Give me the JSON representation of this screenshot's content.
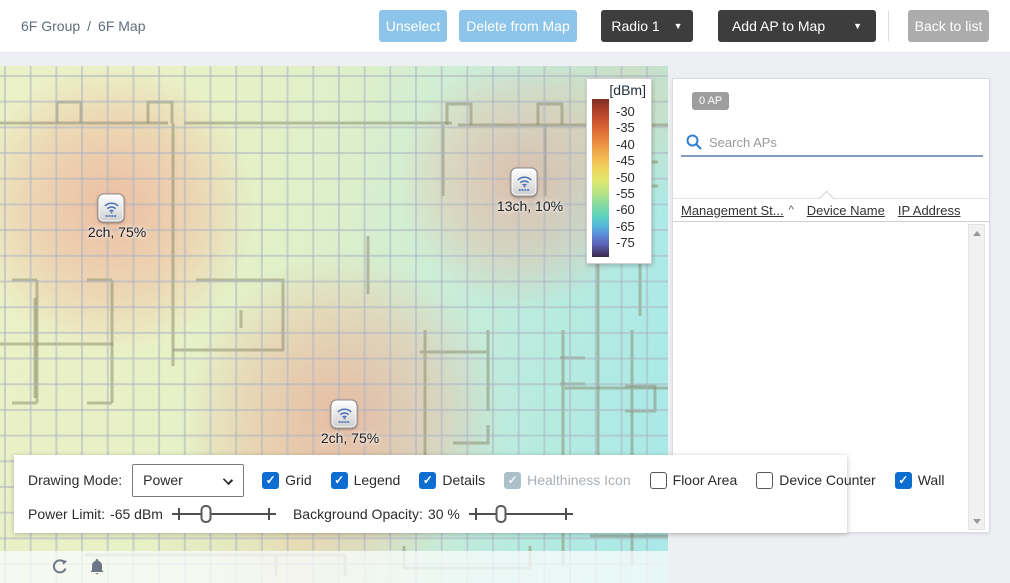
{
  "breadcrumb": {
    "group": "6F Group",
    "separator": "/",
    "map": "6F Map"
  },
  "toolbar": {
    "unselect": "Unselect",
    "delete_from_map": "Delete from Map",
    "radio_select": "Radio 1",
    "add_ap_to_map": "Add AP to Map",
    "back_to_list": "Back to list",
    "caret": "▼"
  },
  "legend": {
    "title": "[dBm]",
    "ticks": [
      "-30",
      "-35",
      "-40",
      "-45",
      "-50",
      "-55",
      "-60",
      "-65",
      "-75"
    ]
  },
  "map": {
    "aps": [
      {
        "label": "2ch, 75%",
        "x": 111,
        "y": 142
      },
      {
        "label": "13ch, 10%",
        "x": 524,
        "y": 116
      },
      {
        "label": "2ch, 75%",
        "x": 344,
        "y": 348
      }
    ]
  },
  "ap_panel": {
    "count_badge": "0 AP",
    "search_placeholder": "Search APs",
    "columns": [
      {
        "label": "Management St...",
        "sort": "^"
      },
      {
        "label": "Device Name"
      },
      {
        "label": "IP Address"
      }
    ],
    "rows": []
  },
  "controls": {
    "drawing_mode_label": "Drawing Mode:",
    "drawing_mode_value": "Power",
    "checkboxes": [
      {
        "label": "Grid",
        "checked": true,
        "disabled": false
      },
      {
        "label": "Legend",
        "checked": true,
        "disabled": false
      },
      {
        "label": "Details",
        "checked": true,
        "disabled": false
      },
      {
        "label": "Healthiness Icon",
        "checked": true,
        "disabled": true
      },
      {
        "label": "Floor Area",
        "checked": false,
        "disabled": false
      },
      {
        "label": "Device Counter",
        "checked": false,
        "disabled": false
      },
      {
        "label": "Wall",
        "checked": true,
        "disabled": false
      }
    ],
    "power_limit": {
      "label": "Power Limit:",
      "value": "-65 dBm",
      "percent": 33
    },
    "background_opacity": {
      "label": "Background Opacity:",
      "value": "30 %",
      "percent": 31
    }
  },
  "colors": {
    "button_blue": "#8cc5e9",
    "button_dark": "#3d3d3d",
    "button_gray": "#acacac",
    "checkbox_blue": "#0d6dd1",
    "search_icon_blue": "#2f7fd0",
    "badge_gray": "#9d9d9d",
    "heat_hot": "#eb8c76",
    "heat_cold": "#9ae5e3"
  }
}
